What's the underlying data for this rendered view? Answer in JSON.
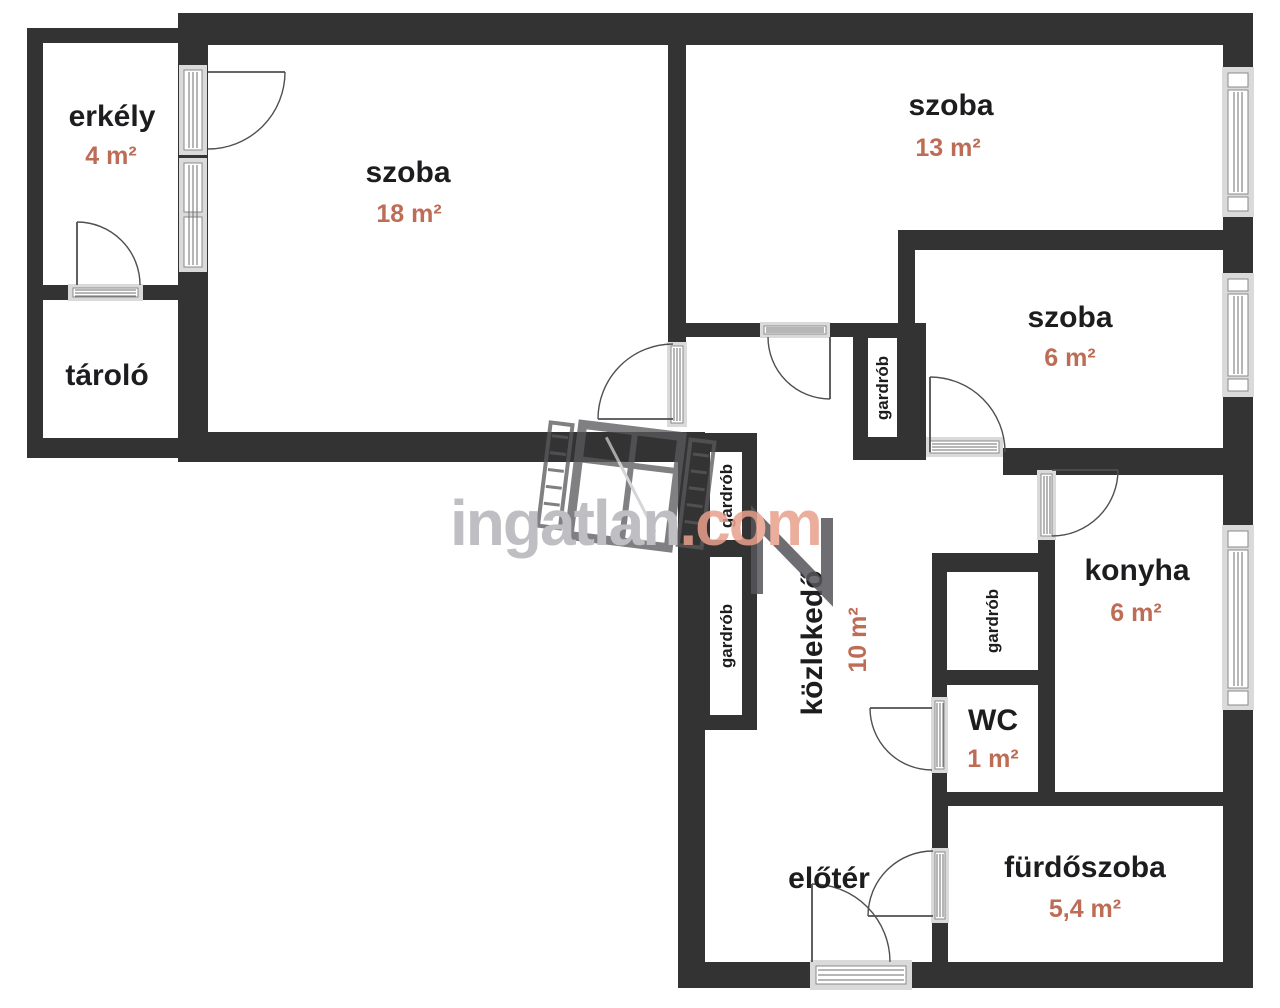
{
  "watermark": {
    "brand": "ingatlan",
    "tld": ".com"
  },
  "rooms": [
    {
      "name": "erkély",
      "area": "4 m²"
    },
    {
      "name": "szoba",
      "area": "18 m²"
    },
    {
      "name": "szoba",
      "area": "13 m²"
    },
    {
      "name": "szoba",
      "area": "6 m²"
    },
    {
      "name": "tároló",
      "area": ""
    },
    {
      "name": "közlekedő",
      "area": "10 m²"
    },
    {
      "name": "konyha",
      "area": "6 m²"
    },
    {
      "name": "WC",
      "area": "1 m²"
    },
    {
      "name": "előtér",
      "area": ""
    },
    {
      "name": "fürdőszoba",
      "area": "5,4 m²"
    }
  ],
  "closets": [
    {
      "label": "gardrób"
    },
    {
      "label": "gardrób"
    },
    {
      "label": "gardrób"
    },
    {
      "label": "gardrób"
    }
  ],
  "colors": {
    "wall": "#333333",
    "room_text": "#1d1d1f",
    "area_text": "#bd6c55",
    "watermark_gray": "#b5b5b9",
    "watermark_accent": "#e8a18c"
  }
}
